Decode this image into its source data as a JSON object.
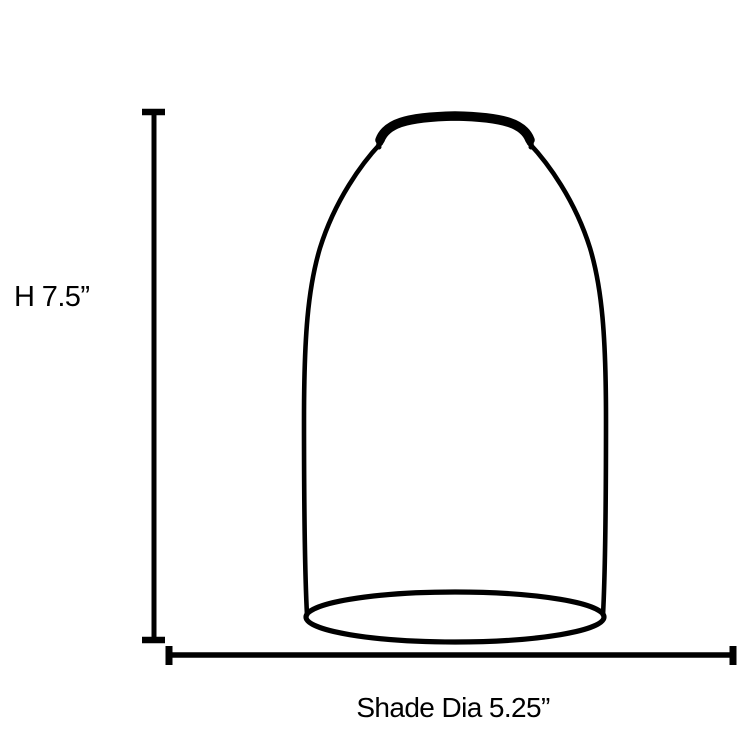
{
  "diagram": {
    "ink": "#000000",
    "background": "#ffffff",
    "height_dimension": {
      "label": "H 7.5”"
    },
    "diameter_dimension": {
      "label": "Shade Dia 5.25”"
    }
  }
}
